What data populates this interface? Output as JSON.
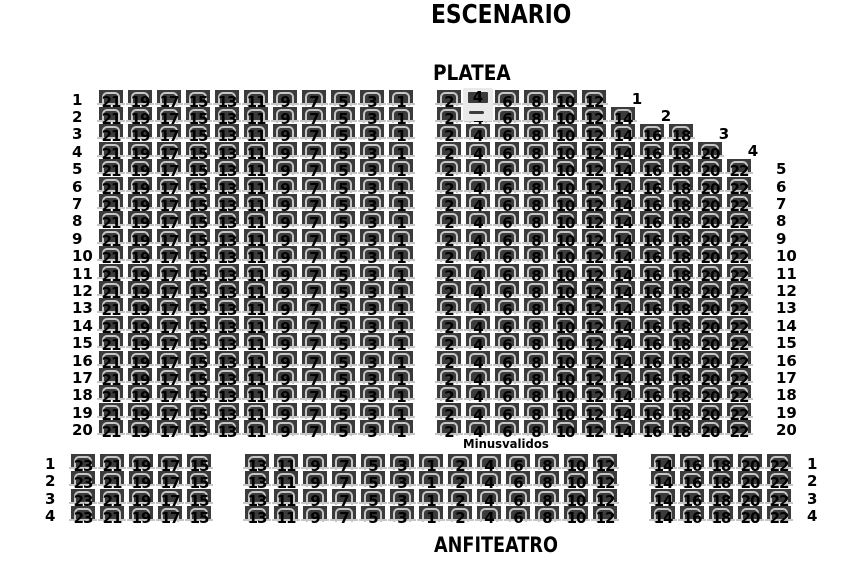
{
  "titles": {
    "stage": "ESCENARIO",
    "platea": "PLATEA",
    "anfiteatro": "ANFITEATRO",
    "accessible": "Minusvalidos"
  },
  "platea": {
    "row_count": 20,
    "left_row_labels": [
      "1",
      "2",
      "3",
      "4",
      "5",
      "6",
      "7",
      "8",
      "9",
      "10",
      "11",
      "12",
      "13",
      "14",
      "15",
      "16",
      "17",
      "18",
      "19",
      "20"
    ],
    "right_row_labels": [
      "5",
      "6",
      "7",
      "8",
      "9",
      "10",
      "11",
      "12",
      "13",
      "14",
      "15",
      "16",
      "17",
      "18",
      "19",
      "20"
    ],
    "right_row_labels_start_row": 5,
    "step_row_labels": [
      "1",
      "2",
      "3",
      "4"
    ],
    "left_block": {
      "columns": [
        "21",
        "19",
        "17",
        "15",
        "13",
        "11",
        "9",
        "7",
        "5",
        "3",
        "1"
      ]
    },
    "right_block": {
      "columns": [
        "2",
        "4",
        "6",
        "8",
        "10",
        "12",
        "14",
        "16",
        "18",
        "20",
        "22"
      ],
      "row_seat_counts_top": [
        6,
        7,
        9,
        10
      ],
      "full_row_seat_count": 11
    },
    "highlighted_seat": {
      "row": 1,
      "number": "4"
    }
  },
  "anfiteatro": {
    "row_count": 4,
    "left_row_labels": [
      "1",
      "2",
      "3",
      "4"
    ],
    "right_row_labels": [
      "1",
      "2",
      "3",
      "4"
    ],
    "left_block": {
      "columns": [
        "23",
        "21",
        "19",
        "17",
        "15"
      ]
    },
    "middle_block": {
      "columns": [
        "13",
        "11",
        "9",
        "7",
        "5",
        "3",
        "1",
        "2",
        "4",
        "6",
        "8",
        "10",
        "12"
      ]
    },
    "right_block": {
      "columns": [
        "14",
        "16",
        "18",
        "20",
        "22"
      ]
    }
  },
  "colors": {
    "background": "#ffffff",
    "seat_fill": "#3b3b3b",
    "seat_trim": "#c6c6c6",
    "seat_number": "#000000",
    "label_text": "#000000",
    "highlighted_fill": "#e9e9e9"
  }
}
